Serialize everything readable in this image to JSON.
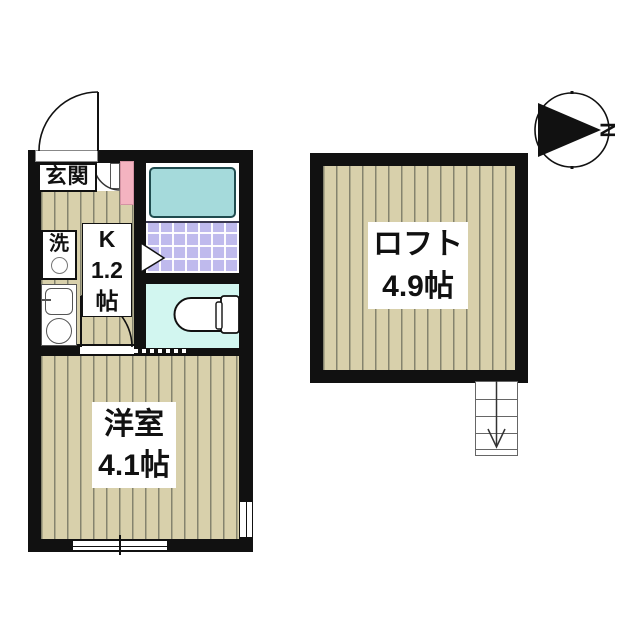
{
  "floorplan": {
    "unit": {
      "entrance_label": "玄関",
      "washer_label": "洗",
      "kitchen_label_lines": [
        "K",
        "1.2",
        "帖"
      ],
      "western_room_label": [
        "洋室",
        "4.1帖"
      ]
    },
    "loft": {
      "label": [
        "ロフト",
        "4.9帖"
      ]
    },
    "compass": {
      "north_label": "N"
    },
    "colors": {
      "wall": "#111111",
      "wood_floor": "#d8d0ab",
      "plank_line": "#84836e",
      "bathtub_fill": "#a5dadb",
      "tile_fill": "#bfbaed",
      "toilet_room_fill": "#d2f6f0",
      "door_pink": "#f4b3c0"
    }
  }
}
